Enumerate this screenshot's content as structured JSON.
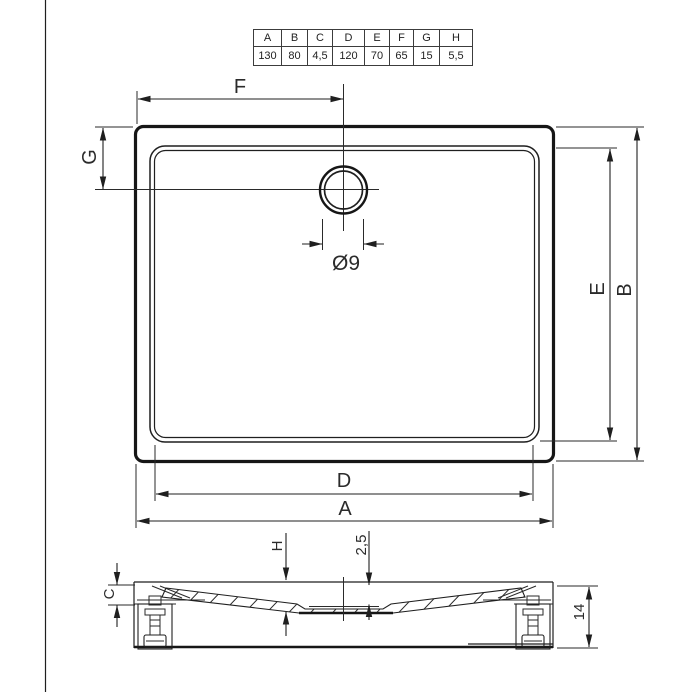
{
  "dimension_table": {
    "headers": [
      "A",
      "B",
      "C",
      "D",
      "E",
      "F",
      "G",
      "H"
    ],
    "values": [
      "130",
      "80",
      "4,5",
      "120",
      "70",
      "65",
      "15",
      "5,5"
    ]
  },
  "plan_view": {
    "dim_top": "F",
    "dim_left": "G",
    "dim_right_inner": "E",
    "dim_right_outer": "B",
    "dim_bottom_inner": "D",
    "dim_bottom_outer": "A",
    "drain_diameter": "Ø9"
  },
  "section_view": {
    "dim_depth": "H",
    "dim_recess_depth": "2,5",
    "dim_edge_height": "C",
    "dim_total_height": "14"
  },
  "colors": {
    "line": "#1f1f1f",
    "text": "#2b2b2b",
    "background": "#ffffff"
  }
}
